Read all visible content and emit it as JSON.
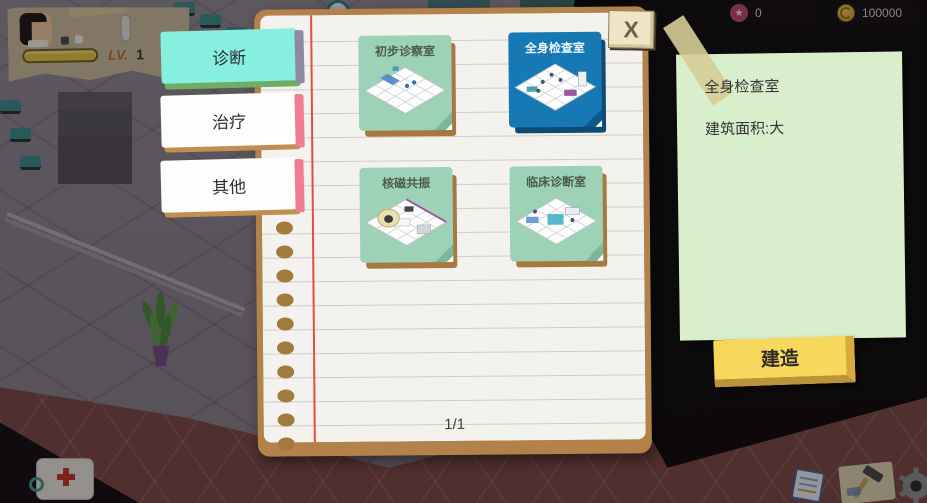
{
  "hud": {
    "level_label": "LV.",
    "level_value": "1",
    "star_count": "0",
    "coin_count": "100000"
  },
  "icons": {
    "star": "★",
    "close": "X"
  },
  "tabs": [
    {
      "label": "诊断",
      "active": true
    },
    {
      "label": "治疗",
      "active": false
    },
    {
      "label": "其他",
      "active": false
    }
  ],
  "build_menu": {
    "page_indicator": "1/1",
    "cards": [
      {
        "label": "初步诊察室",
        "selected": false
      },
      {
        "label": "全身检查室",
        "selected": true
      },
      {
        "label": "核磁共振",
        "selected": false
      },
      {
        "label": "临床诊断室",
        "selected": false
      }
    ]
  },
  "detail_panel": {
    "room_name": "全身检查室",
    "area_label": "建筑面积:大",
    "build_label": "建造"
  },
  "colors": {
    "active_tab": "#87efe0",
    "selected_card": "#1779b4",
    "card_green": "#9ed2b7",
    "note_green": "#d9efcb",
    "build_yellow": "#f8d85c"
  }
}
